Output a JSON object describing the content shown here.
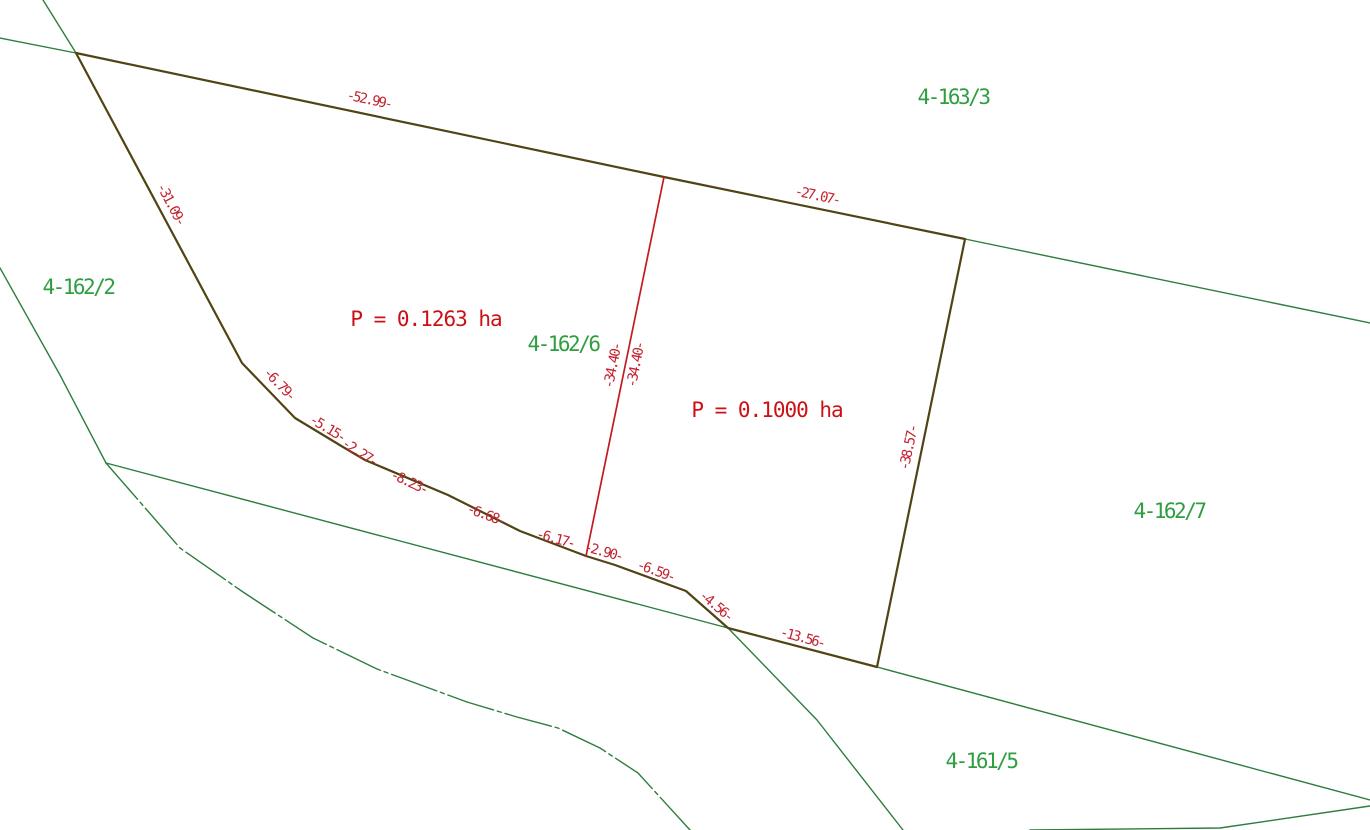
{
  "map": {
    "kind": "cadastral-parcel-plan",
    "colors": {
      "background": "#ffffff",
      "boundary_green": "#2e7d3e",
      "label_green": "#2f9e41",
      "highlight_outline": "#514414",
      "divider_red": "#c41a1f",
      "dimension_red": "#c32330",
      "area_red": "#cc1016"
    },
    "parcel_labels": [
      {
        "text": "4-163/3"
      },
      {
        "text": "4-162/2"
      },
      {
        "text": "4-162/6"
      },
      {
        "text": "4-162/7"
      },
      {
        "text": "4-161/5"
      }
    ],
    "area_labels": [
      {
        "text": "P = 0.1263 ha"
      },
      {
        "text": "P = 0.1000 ha"
      }
    ],
    "dimension_labels": [
      {
        "text": "-52.99-"
      },
      {
        "text": "-27.07-"
      },
      {
        "text": "-31.09-"
      },
      {
        "text": "-6.79-"
      },
      {
        "text": "-5.15-"
      },
      {
        "text": "-2.27-"
      },
      {
        "text": "-8.23-"
      },
      {
        "text": "-6.68-"
      },
      {
        "text": "-6.17-"
      },
      {
        "text": "-2.90-"
      },
      {
        "text": "-6.59-"
      },
      {
        "text": "-4.56-"
      },
      {
        "text": "-13.56-"
      },
      {
        "text": "-34.40-"
      },
      {
        "text": "-34.40-"
      },
      {
        "text": "-38.57-"
      }
    ]
  }
}
